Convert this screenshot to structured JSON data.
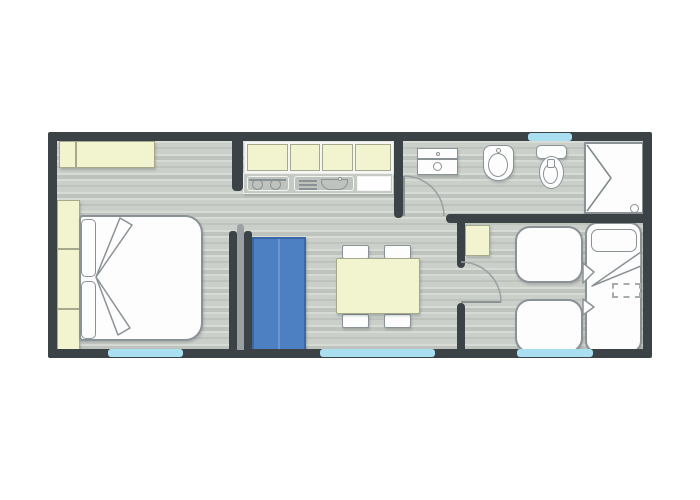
{
  "document": {
    "type": "floor-plan",
    "visible_text": "none",
    "style": "top-down architectural plan of a mobile home"
  },
  "colors": {
    "wall": "#3b4347",
    "floorA": "#cbcfc9",
    "floorB": "#d7dbd5",
    "floorC": "#bfc3bd",
    "cream": "#f2f3cf",
    "creamBorder": "#a4aa8b",
    "blue": "#4c80c2",
    "blueBorder": "#3a68a6",
    "blueLine": "#6b96cf",
    "window": "#a9dff0",
    "stroke": "#8b9296",
    "white": "#fdfdfd",
    "counter": "#c6cac4",
    "counterBox": "#bfc3bd",
    "doorGray": "#9aa0a3"
  },
  "plan": {
    "rooms": [
      {
        "name": "master-bedroom",
        "position": "left",
        "furniture": [
          "double-bed",
          "two-pillows",
          "wardrobe-3-sections",
          "overhead-cabinet"
        ]
      },
      {
        "name": "kitchen-living",
        "position": "center",
        "furniture": [
          "kitchen-cabinet-4-doors",
          "cooktop-2-burners",
          "sink-with-drainboard",
          "dining-table",
          "four-chairs",
          "blue-sofa"
        ]
      },
      {
        "name": "bathroom",
        "position": "top-right",
        "furniture": [
          "washbasin",
          "bidet",
          "toilet",
          "corner-shower-with-drain"
        ]
      },
      {
        "name": "twin-bedroom",
        "position": "bottom-right",
        "furniture": [
          "small-cabinet",
          "short-bed-upper",
          "short-bed-lower",
          "single-bed-with-pillow",
          "dashed-storage-area"
        ]
      }
    ],
    "doors": [
      {
        "type": "sliding-pocket",
        "location": "master-bedroom-entry"
      },
      {
        "type": "hinged",
        "location": "bathroom-entry"
      },
      {
        "type": "hinged",
        "location": "twin-bedroom-entry"
      }
    ],
    "windows": [
      {
        "location": "master-bedroom-south"
      },
      {
        "location": "living-area-south"
      },
      {
        "location": "twin-bedroom-south"
      },
      {
        "location": "bathroom-north"
      }
    ]
  }
}
